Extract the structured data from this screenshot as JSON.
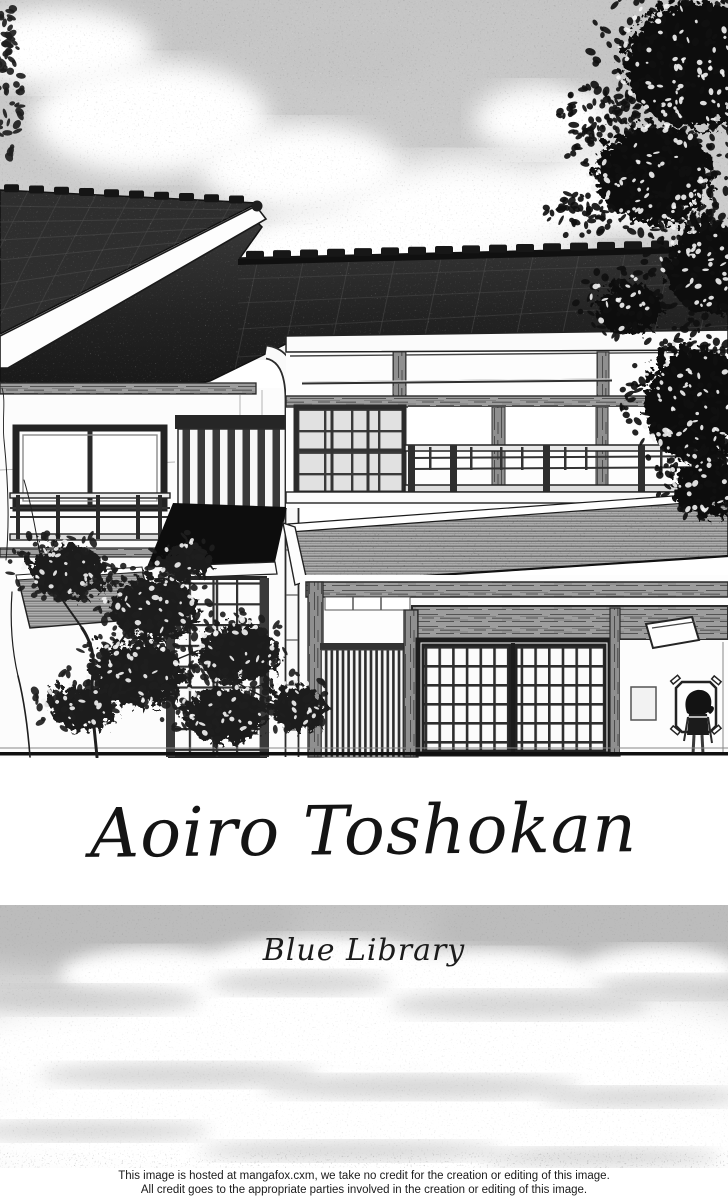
{
  "artwork": {
    "title": "Aoiro Toshokan",
    "subtitle": "Blue Library"
  },
  "footer": {
    "line1": "This image is hosted at mangafox.cxm, we take no credit for the creation or editing of this image.",
    "line2": "All credit goes to the appropriate parties involved in the creation or editing of this image."
  },
  "scene": {
    "description": "Black-and-white manga illustration of a traditional two-story Japanese house: long tiled roof, left gable roof, shoji windows, second-floor balcony railing, striped awning, slatted entrance doors, vertical slat screen, leafy tree at right, small bare tree at left, and a small person standing by a sign near the entrance, under a cloudy screentone sky with a cloud bank below",
    "colors": {
      "ink": "#1a1a1a",
      "sky_tone": "#c9c9c9",
      "roof_dark": "#222222",
      "awning_gray": "#adadad",
      "paper_white": "#ffffff",
      "cloud_light": "#e8e8e8"
    }
  }
}
